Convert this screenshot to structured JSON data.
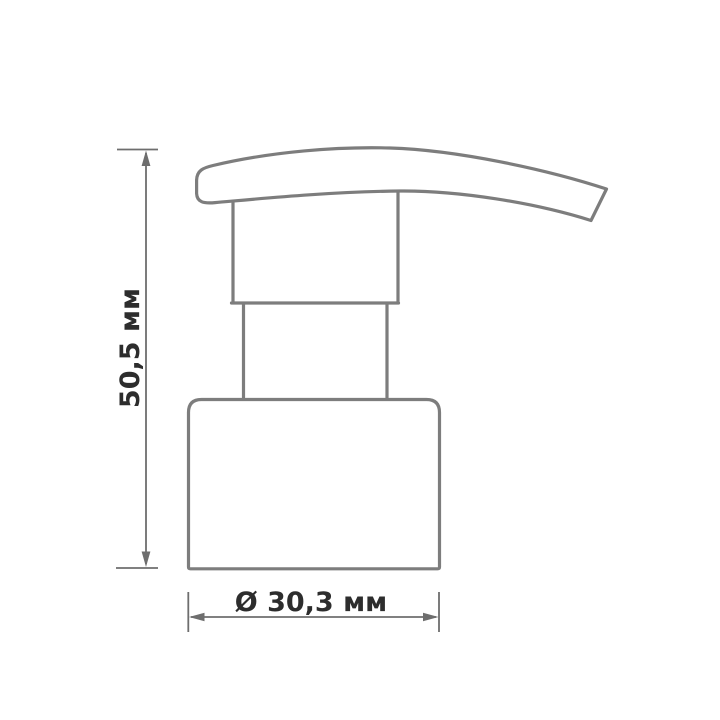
{
  "diagram": {
    "type": "technical-dimension-drawing",
    "subject": "soap dispenser pump head (side view)",
    "height_dimension": {
      "label": "50,5 мм",
      "orientation": "vertical",
      "value_mm": 50.5
    },
    "diameter_dimension": {
      "label": "Ø 30,3 мм",
      "orientation": "horizontal",
      "value_mm": 30.3
    },
    "colors": {
      "outline": "#7d7d7d",
      "dimension_lines": "#6e6e6e",
      "label_text": "#2d2d2d",
      "background": "#ffffff"
    }
  }
}
